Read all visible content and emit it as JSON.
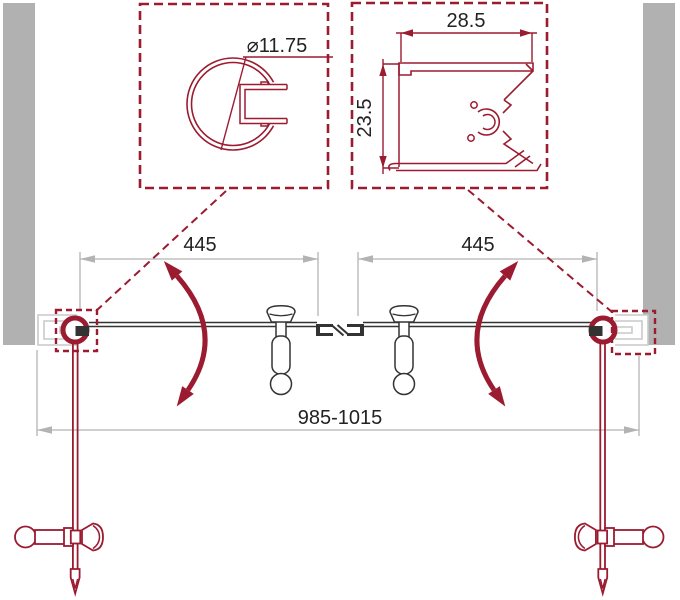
{
  "drawing": {
    "kind": "technical-diagram",
    "subject": "double swing glass door - top plan view with profile details"
  },
  "colors": {
    "accent_red": "#9b1b31",
    "line_black": "#333333",
    "dim_gray": "#b3b3b3",
    "wall_gray": "#b1b1b1",
    "profile_gray": "#c9c9c9",
    "text_ink": "#222222"
  },
  "labels": {
    "pivot_profile_diameter": "⌀11.75",
    "wall_profile_width": "28.5",
    "wall_profile_height": "23.5",
    "left_door_width": "445",
    "right_door_width": "445",
    "total_width_range": "985-1015"
  }
}
